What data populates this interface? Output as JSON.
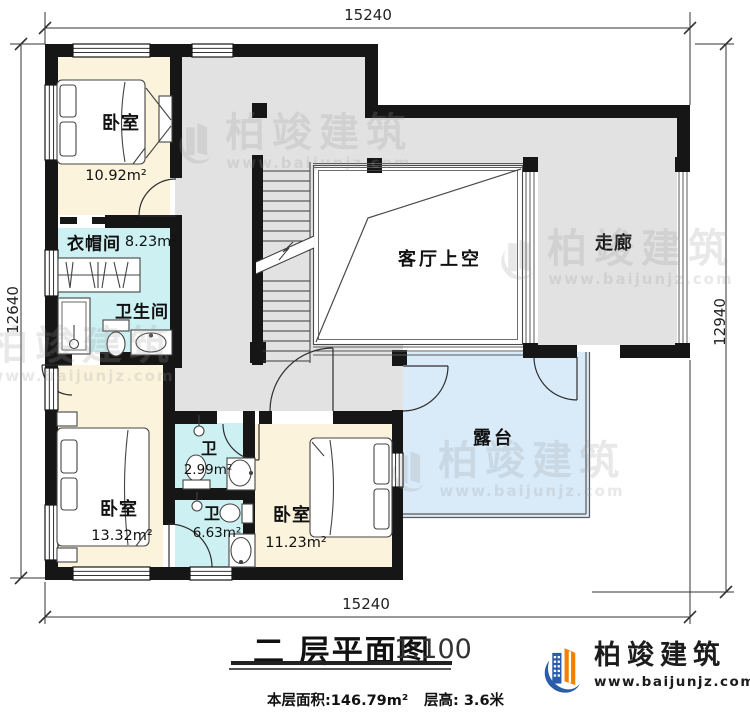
{
  "dims": {
    "top": "15240",
    "bottom": "15240",
    "left": "12640",
    "right": "12940"
  },
  "rooms": {
    "bedroom1": {
      "name": "卧室",
      "area": "10.92m²"
    },
    "cloakroom": {
      "name": "衣帽间",
      "area": "8.23m²"
    },
    "bathroom": {
      "name": "卫生间"
    },
    "void": {
      "name": "客厅上空"
    },
    "corridor": {
      "name": "走廊"
    },
    "bedroom2": {
      "name": "卧室",
      "area": "13.32m²"
    },
    "wc1": {
      "name": "卫",
      "area": "2.99m²"
    },
    "wc2": {
      "name": "卫",
      "area": "6.63m²"
    },
    "bedroom3": {
      "name": "卧室",
      "area": "11.23m²"
    },
    "terrace": {
      "name": "露台"
    }
  },
  "title": {
    "text": "二 层平面图",
    "scale": "1:100",
    "floor_area": "本层面积:146.79m²",
    "floor_height": "层高: 3.6米"
  },
  "brand": {
    "name": "柏竣建筑",
    "url": "www.baijunjz.com"
  },
  "watermark": {
    "name": "柏竣建筑",
    "url": "www.baijunjz.com"
  },
  "colors": {
    "wall": "#161616",
    "bedroom": "#fbf3dc",
    "wet": "#cdf0f2",
    "hall": "#e2e2e2",
    "terrace": "#d9eaf8",
    "void": "#ffffff",
    "brand_blue": "#2a5caa",
    "brand_orange": "#ef8200"
  }
}
